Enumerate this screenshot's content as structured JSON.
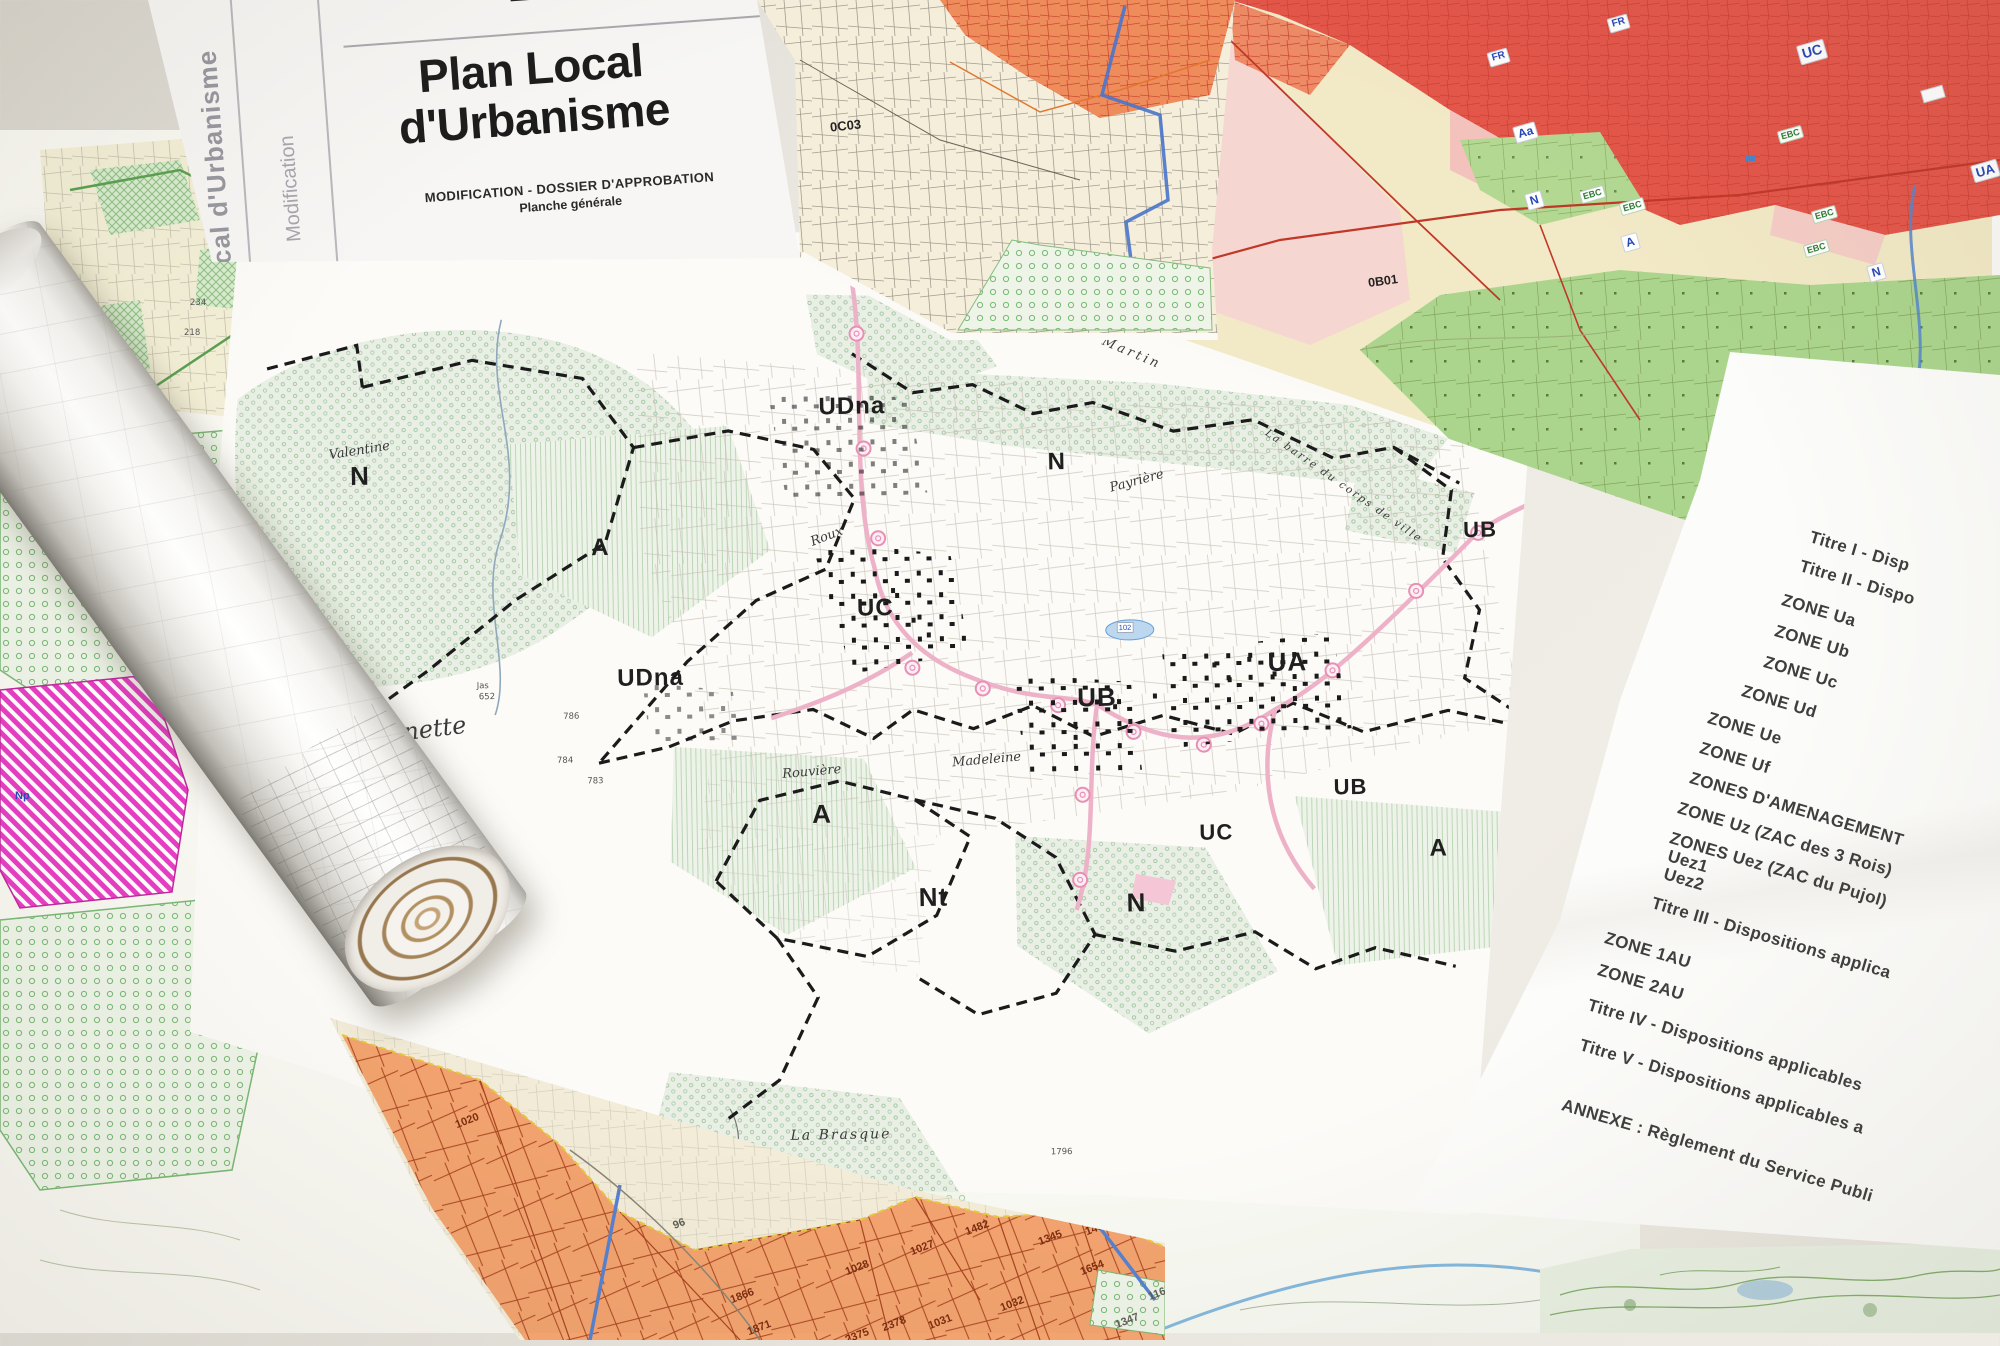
{
  "title_sheet": {
    "side_label": "cal d'Urbanisme",
    "side_label_2": "Modification",
    "title_line_1": "Plan Local",
    "title_line_2": "d'Urbanisme",
    "subtitle_1": "MODIFICATION - DOSSIER D'APPROBATION",
    "subtitle_2": "Planche générale"
  },
  "toc_sheet": {
    "items": [
      "Titre I - Disp",
      "Titre II - Dispo",
      "ZONE Ua",
      "ZONE Ub",
      "ZONE Uc",
      "ZONE Ud",
      "ZONE Ue",
      "ZONE Uf",
      "ZONES D'AMENAGEMENT",
      "ZONE Uz (ZAC des 3 Rois)",
      "ZONES Uez (ZAC du Pujol)",
      "Uez1",
      "Uez2",
      "Titre III - Dispositions applica",
      "ZONE 1AU",
      "ZONE 2AU",
      "Titre IV - Dispositions applicables",
      "Titre V - Dispositions applicables a",
      "ANNEXE : Règlement du Service Publi"
    ]
  },
  "central_map": {
    "zone_labels": [
      "N",
      "A",
      "UDna",
      "UDna",
      "UC",
      "N",
      "UA",
      "UB",
      "A",
      "Nt",
      "N",
      "UC",
      "A",
      "UB",
      "UB",
      "N"
    ],
    "place_labels": [
      "Valentine",
      "Roux",
      "Payrière",
      "La barre du corps de ville",
      "Coulet de Martin",
      "Madeleine",
      "Rouvière",
      "ounette",
      "La Brasque"
    ],
    "parcel_numbers": [
      "Jas",
      "652",
      "786",
      "784",
      "783",
      "1796"
    ],
    "pond_label": "102"
  },
  "cadastral_sheet": {
    "code": "0C03"
  },
  "zoning_sheet": {
    "code": "0B01",
    "labels": [
      "FR",
      "FR",
      "UC",
      "UA",
      "Aa",
      "N",
      "A",
      "N"
    ],
    "ebc_labels": [
      "EBC",
      "EBC",
      "EBC",
      "EBC",
      "EBC"
    ]
  },
  "pastel_sheet": {
    "zone_label": "Np",
    "numbers": [
      "234",
      "218",
      "1113"
    ]
  },
  "orange_sheet": {
    "numbers": [
      "96",
      "1020",
      "1866",
      "1871",
      "1028",
      "1027",
      "2375",
      "2378",
      "1031",
      "1032",
      "1482",
      "1345",
      "1451",
      "1654",
      "1165",
      "1347"
    ]
  },
  "colors": {
    "urban_red": "#e4564a",
    "orange_parcel": "#f3a36e",
    "zone_green": "#abd58d",
    "magenta_zone": "#e83cc4",
    "road_pink": "#eeb2c8",
    "boundary_blue": "#4a74ca",
    "label_blue": "#2847b8",
    "ebc_green": "#2e7d32"
  }
}
